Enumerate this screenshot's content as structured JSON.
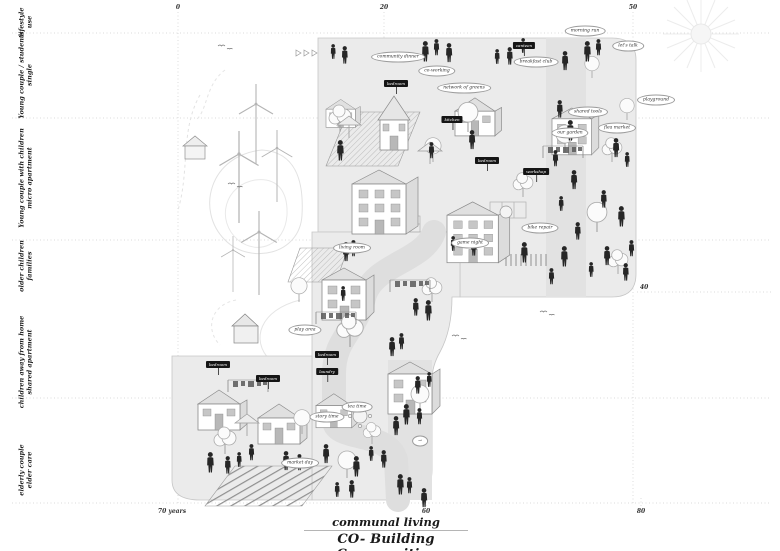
{
  "title": {
    "line1": "communal living",
    "line2": "CO- Building Communities"
  },
  "axis": {
    "top_ticks": [
      {
        "label": "0",
        "x": 178
      },
      {
        "label": "20",
        "x": 384
      },
      {
        "label": "50",
        "x": 633
      }
    ],
    "bottom_ticks": [
      {
        "label": "70 years",
        "x": 172
      },
      {
        "label": "60",
        "x": 426
      },
      {
        "label": "80",
        "x": 641
      }
    ],
    "right_tick": {
      "label": "40",
      "x": 640,
      "y": 285
    }
  },
  "stages": [
    {
      "line1": "lifestyle",
      "line2": "use",
      "y": 22
    },
    {
      "line1": "Young couple / students",
      "line2": "single",
      "y": 75
    },
    {
      "line1": "Young couple with children",
      "line2": "micro apartment",
      "y": 178
    },
    {
      "line1": "older children",
      "line2": "families",
      "y": 266
    },
    {
      "line1": "children away from home",
      "line2": "shared apartment",
      "y": 362
    },
    {
      "line1": "elderly couple",
      "line2": "elder care",
      "y": 470
    }
  ],
  "signs": [
    {
      "text": "bedroom",
      "x": 396,
      "y": 80
    },
    {
      "text": "canteen",
      "x": 524,
      "y": 42
    },
    {
      "text": "kitchen",
      "x": 452,
      "y": 116
    },
    {
      "text": "bedroom",
      "x": 487,
      "y": 157
    },
    {
      "text": "workshop",
      "x": 536,
      "y": 168
    },
    {
      "text": "bedroom",
      "x": 218,
      "y": 361
    },
    {
      "text": "bedroom",
      "x": 268,
      "y": 375
    },
    {
      "text": "bedroom",
      "x": 327,
      "y": 351
    },
    {
      "text": "laundry",
      "x": 327,
      "y": 368
    }
  ],
  "bubbles": [
    {
      "text": "morning run",
      "x": 585,
      "y": 31
    },
    {
      "text": "let's talk",
      "x": 628,
      "y": 46
    },
    {
      "text": "playground",
      "x": 656,
      "y": 100
    },
    {
      "text": "shared tools",
      "x": 588,
      "y": 112
    },
    {
      "text": "our garden",
      "x": 570,
      "y": 133
    },
    {
      "text": "flea market",
      "x": 617,
      "y": 128
    },
    {
      "text": "breakfast club",
      "x": 536,
      "y": 62
    },
    {
      "text": "network of greens",
      "x": 464,
      "y": 88
    },
    {
      "text": "co-working",
      "x": 437,
      "y": 71
    },
    {
      "text": "community dinner",
      "x": 398,
      "y": 57
    },
    {
      "text": "game night",
      "x": 470,
      "y": 243
    },
    {
      "text": "bike repair",
      "x": 540,
      "y": 228
    },
    {
      "text": "living room",
      "x": 352,
      "y": 248
    },
    {
      "text": "play area",
      "x": 305,
      "y": 330
    },
    {
      "text": "tea time",
      "x": 357,
      "y": 407
    },
    {
      "text": "story time",
      "x": 327,
      "y": 417
    },
    {
      "text": "market day",
      "x": 300,
      "y": 463
    },
    {
      "text": "→",
      "x": 420,
      "y": 441
    }
  ],
  "palette": {
    "platform": "#ebebeb",
    "path": "#dedede",
    "figure": "#262626",
    "grid_line": "#cfcfcf",
    "outline": "#8a8a8a"
  },
  "icons": [
    "sun-icon",
    "wind-turbine-icon",
    "tree-icon",
    "person-icon",
    "bird-icon",
    "umbrella-icon",
    "clothesline-icon",
    "house-icon"
  ]
}
